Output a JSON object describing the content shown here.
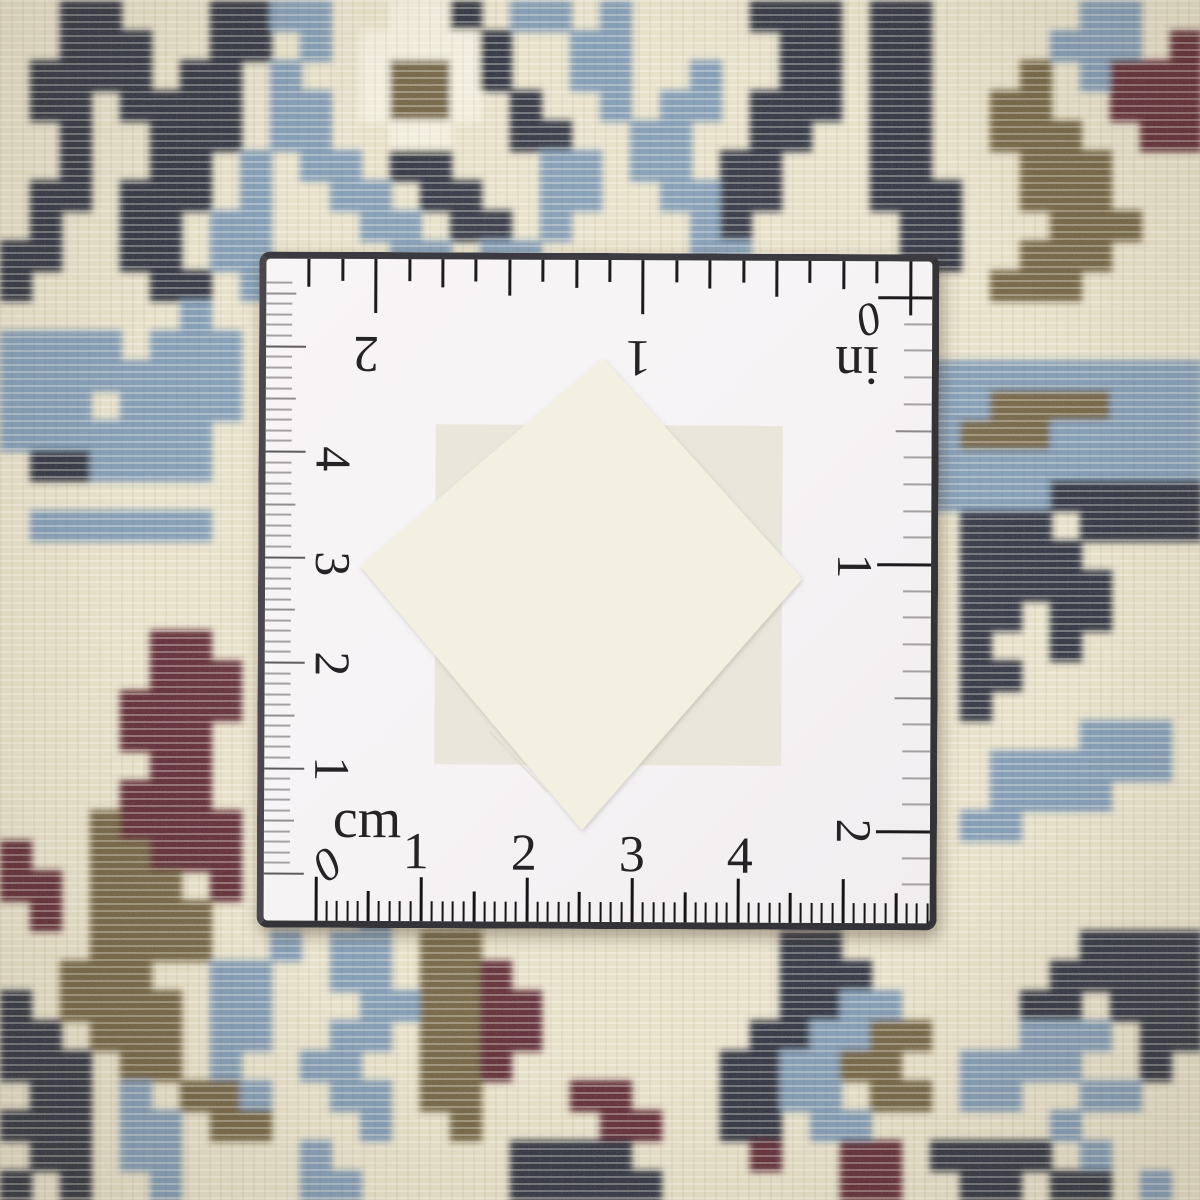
{
  "palette": {
    "carpet_base": "#e7e0c9",
    "navy": "#2b2f3e",
    "blue": "#7e99b4",
    "olive": "#6f6040",
    "maroon": "#5c2631",
    "white_knot": "#f2eddd",
    "ruler_face": "#f6f3f5",
    "ruler_edge": "#343338",
    "tick_black": "#1c1c1e",
    "tick_gray": "#a5a1a2"
  },
  "carpet": {
    "cell_px": 30,
    "legend": {
      ".": "carpet_base",
      "N": "navy",
      "B": "blue",
      "O": "olive",
      "R": "maroon",
      "W": "white_knot"
    },
    "pattern_grid": [
      "..NN...NNBB..WWN.BB.B....NNN.NN.....BB..",
      "..NNN..NN.B.WWWWN..BB.....NN.NN....BBB.R",
      ".NNNN.NN.B..WOOWN..BB..B..NN.NN...O.BRRR",
      ".NN.NNNN.BB.WOOW.N..B.BB.NNN.NN..OO..RRR",
      "..N..NNN.BB..WW..NN..BB..NN..NN..OOO..RR",
      "..N..NN.B.BB.NN...BB.BB.NN...NN...OOO...",
      ".NN.NNN.B..BB.NN..BB..BBNN...NNN..OOO...",
      ".N..NN.BB...BB.NN.B....BN.....NN...OOO..",
      "NN..NN.BB....BB.BB.....BB.....NN..OOO...",
      "N....NN.B.....BB........B........OOO....",
      "......B.................................",
      "BBBB.BBB................................",
      "BBBBBBBB......................BBBBBBBBBB",
      "BBB.BBBB......................BBBOOOOBBB",
      "BBBBBBB.......................BBOOOBBBBB",
      ".NNBBBB.......................BBBBBBBBBB",
      "..............................BBBBBNNNNN",
      ".BBBBBB.........................NNN.NNNN",
      "................................NNNN....",
      "................................NNNNN...",
      "................................NN.NN...",
      ".....RR.........................N..N....",
      ".....RRR........................NN......",
      "....RRRR........................N.......",
      "....RRR.............................BBB.",
      ".....RR..........................BBBBBB.",
      "....RRR..........................BBBB...",
      "...ORRRR........................BB......",
      "R..OORRR................................",
      "RR.OOO.R................................",
      ".R.OOOO.....B...........................",
      "...OOOO..B.BB.OO..........NN........NNNN",
      "..OOO..BB..BB.OOR.........NNN......NNNNN",
      "N.OOOO.BB...BBOORR........NNBB....NN.NNN",
      "NN.OOO.BB..BB.OORR.......NNBBOO...BBB.NN",
      "NNN.OO.B..BB..OOR.......NNBBOO..BBBB..N.",
      ".NN.B.OOB..BB.OO...RR...NNBB.OO.BB..BB..",
      "NNN.BB.OO...B..O....RR..NN.BB......B....",
      ".NN.BB....B......NNNN....R..RR.NNNN.B...",
      "N.N..B....BB.....NNNNN......RR..NN.NN.B."
    ]
  },
  "ruler": {
    "unit_inch_label": "in",
    "unit_cm_label": "cm",
    "inch_zero": "0",
    "cm_zero": "0",
    "top_inch_numbers": [
      "2",
      "1"
    ],
    "right_inch_numbers": [
      "1",
      "2"
    ],
    "left_cm_numbers": [
      "4",
      "3",
      "2",
      "1"
    ],
    "bottom_cm_numbers": [
      "1",
      "2",
      "3",
      "4"
    ]
  },
  "swatches": {
    "front_diamond_color": "#f3f0e2",
    "back_square_color": "#e9e6dc"
  }
}
